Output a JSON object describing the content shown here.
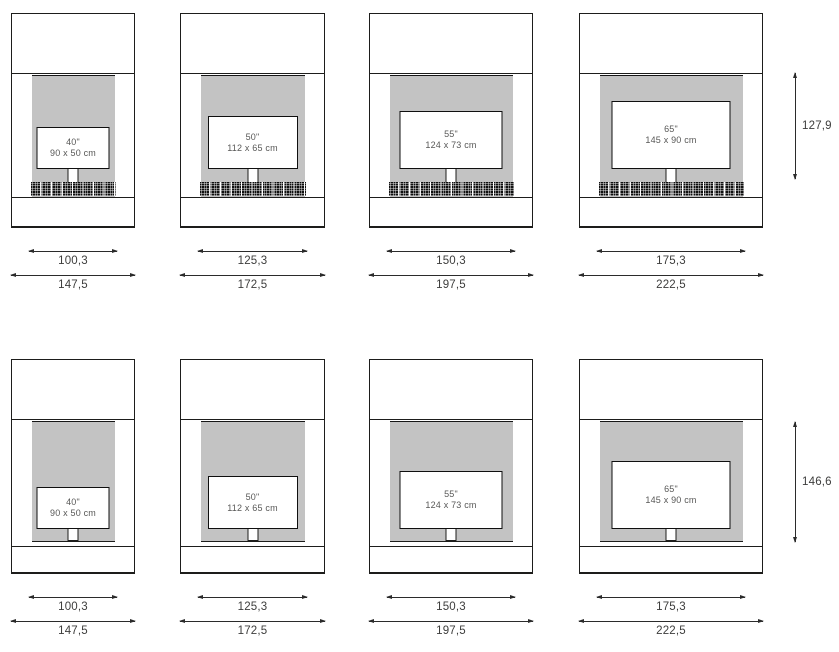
{
  "rows": [
    {
      "side_height": "127,9",
      "units": [
        {
          "tv_size": "40\"",
          "tv_dims": "90 x 50 cm",
          "inner_width": "100,3",
          "outer_width": "147,5"
        },
        {
          "tv_size": "50\"",
          "tv_dims": "112 x 65 cm",
          "inner_width": "125,3",
          "outer_width": "172,5"
        },
        {
          "tv_size": "55\"",
          "tv_dims": "124 x 73 cm",
          "inner_width": "150,3",
          "outer_width": "197,5"
        },
        {
          "tv_size": "65\"",
          "tv_dims": "145 x 90 cm",
          "inner_width": "175,3",
          "outer_width": "222,5"
        }
      ]
    },
    {
      "side_height": "146,6",
      "units": [
        {
          "tv_size": "40\"",
          "tv_dims": "90 x 50 cm",
          "inner_width": "100,3",
          "outer_width": "147,5"
        },
        {
          "tv_size": "50\"",
          "tv_dims": "112 x 65 cm",
          "inner_width": "125,3",
          "outer_width": "172,5"
        },
        {
          "tv_size": "55\"",
          "tv_dims": "124 x 73 cm",
          "inner_width": "150,3",
          "outer_width": "197,5"
        },
        {
          "tv_size": "65\"",
          "tv_dims": "145 x 90 cm",
          "inner_width": "175,3",
          "outer_width": "222,5"
        }
      ]
    }
  ],
  "colors": {
    "panel_gray": "#c3c3c3",
    "line": "#1d1d1b",
    "dimension_text": "#3d3d3c",
    "tv_label_text": "#575756"
  }
}
